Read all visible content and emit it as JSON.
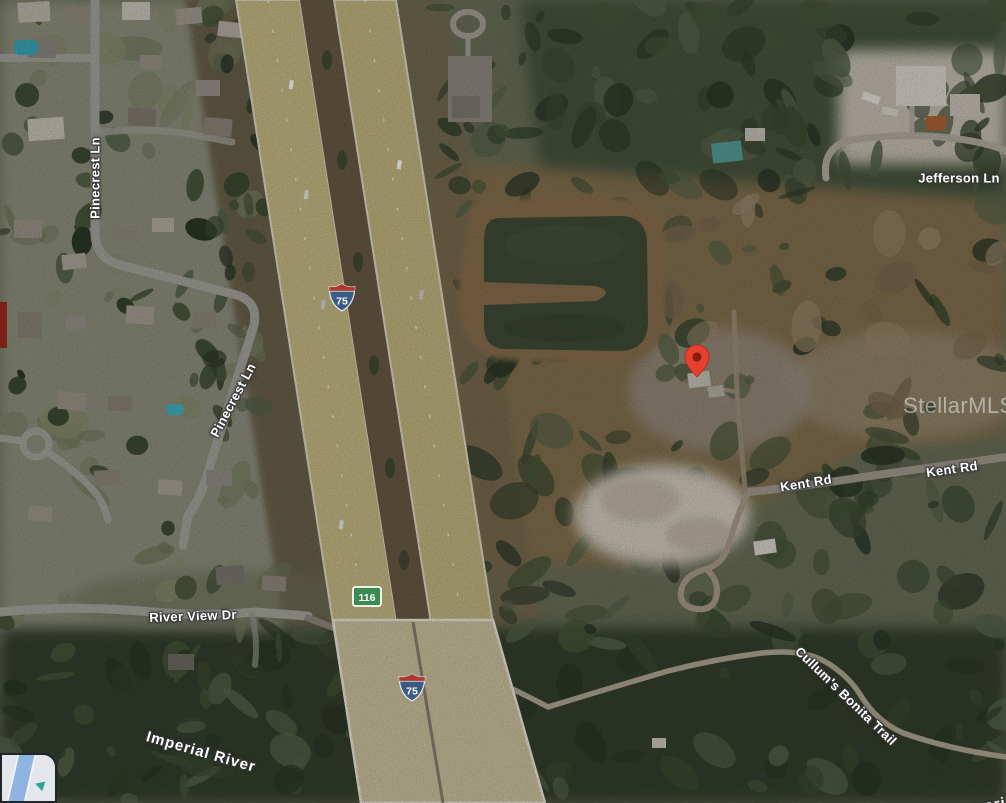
{
  "map": {
    "type_description": "aerial-satellite-view",
    "watermark": {
      "text": "StellarMLS"
    },
    "marker": {
      "x": 697,
      "y": 377,
      "color": "#e8402e",
      "inner_color": "#871c10"
    },
    "labels": [
      {
        "id": "pinecrest-ln-north",
        "text": "Pinecrest Ln",
        "x": 95,
        "y": 178,
        "rotate": -90,
        "kind": "road"
      },
      {
        "id": "jefferson-ln",
        "text": "Jefferson Ln",
        "x": 959,
        "y": 178,
        "rotate": 0,
        "kind": "road"
      },
      {
        "id": "pinecrest-ln-south",
        "text": "Pinecrest Ln",
        "x": 233,
        "y": 400,
        "rotate": -62,
        "kind": "road"
      },
      {
        "id": "kent-rd-west",
        "text": "Kent Rd",
        "x": 806,
        "y": 483,
        "rotate": -9,
        "kind": "road"
      },
      {
        "id": "kent-rd-east",
        "text": "Kent Rd",
        "x": 952,
        "y": 469,
        "rotate": -8,
        "kind": "road"
      },
      {
        "id": "river-view-dr",
        "text": "River View Dr",
        "x": 193,
        "y": 616,
        "rotate": -2,
        "kind": "road"
      },
      {
        "id": "imperial-river",
        "text": "Imperial River",
        "x": 201,
        "y": 752,
        "rotate": 16,
        "kind": "water"
      },
      {
        "id": "cullums-bonita-trail",
        "text": "Cullum's Bonita Trail",
        "x": 846,
        "y": 696,
        "rotate": 44,
        "kind": "road"
      },
      {
        "id": "imperial-river-partial",
        "text": "Imperial",
        "x": 988,
        "y": 806,
        "rotate": -10,
        "kind": "water"
      }
    ],
    "shields": [
      {
        "id": "i75-shield-north",
        "kind": "interstate",
        "number": "75",
        "x": 342,
        "y": 300
      },
      {
        "id": "i75-shield-south",
        "kind": "interstate",
        "number": "75",
        "x": 412,
        "y": 690
      },
      {
        "id": "sr-116-shield",
        "kind": "state",
        "number": "116",
        "x": 367,
        "y": 599
      }
    ],
    "colors": {
      "pin_red": "#e8402e",
      "interstate_blue": "#3b5a86",
      "interstate_red": "#aa3a30",
      "state_route_green": "#3b8a4e",
      "label_text": "#ffffff",
      "water_pond": "#414d36",
      "highway_pavement": "#c9bc85",
      "forest_dark": "#35402e"
    }
  }
}
